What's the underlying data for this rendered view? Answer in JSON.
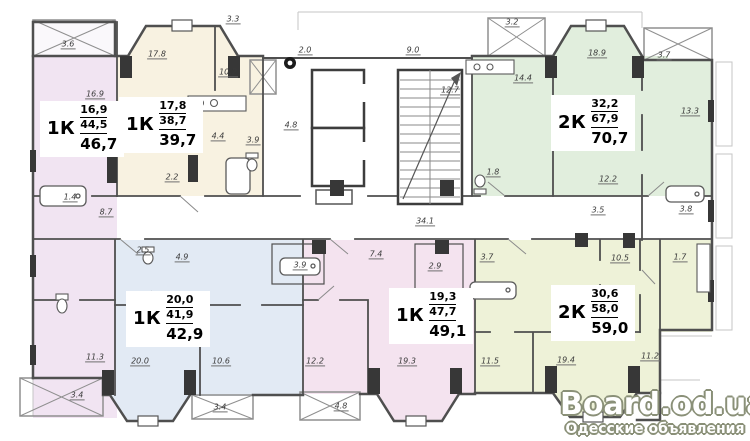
{
  "watermark": {
    "title": "Board.od.ua",
    "subtitle": "Одесские объявления"
  },
  "apartments": [
    {
      "id": "1",
      "type": "1К",
      "area_living": "16,9",
      "area_net": "44,5",
      "area_total": "46,7",
      "color": "#f1e4f2",
      "box": {
        "x": 40,
        "y": 101
      }
    },
    {
      "id": "2",
      "type": "1К",
      "area_living": "17,8",
      "area_net": "38,7",
      "area_total": "39,7",
      "color": "#f8f2e1",
      "box": {
        "x": 119,
        "y": 97
      }
    },
    {
      "id": "3",
      "type": "2К",
      "area_living": "32,2",
      "area_net": "67,9",
      "area_total": "70,7",
      "color": "#e1eedd",
      "box": {
        "x": 551,
        "y": 95
      }
    },
    {
      "id": "4",
      "type": "1К",
      "area_living": "20,0",
      "area_net": "41,9",
      "area_total": "42,9",
      "color": "#e2eaf4",
      "box": {
        "x": 126,
        "y": 291
      }
    },
    {
      "id": "5",
      "type": "1К",
      "area_living": "19,3",
      "area_net": "47,7",
      "area_total": "49,1",
      "color": "#f4e3ef",
      "box": {
        "x": 389,
        "y": 288
      }
    },
    {
      "id": "6",
      "type": "2К",
      "area_living": "30,6",
      "area_net": "58,0",
      "area_total": "59,0",
      "color": "#eef2d8",
      "box": {
        "x": 551,
        "y": 285
      }
    }
  ],
  "dimension_labels": [
    {
      "t": "3.6",
      "x": 68,
      "y": 45
    },
    {
      "t": "17.8",
      "x": 157,
      "y": 55
    },
    {
      "t": "3.3",
      "x": 233,
      "y": 20
    },
    {
      "t": "10.2",
      "x": 228,
      "y": 73
    },
    {
      "t": "2.0",
      "x": 305,
      "y": 51
    },
    {
      "t": "9.0",
      "x": 413,
      "y": 51
    },
    {
      "t": "12.7",
      "x": 450,
      "y": 91
    },
    {
      "t": "3.2",
      "x": 512,
      "y": 23
    },
    {
      "t": "18.9",
      "x": 597,
      "y": 54
    },
    {
      "t": "3.7",
      "x": 664,
      "y": 56
    },
    {
      "t": "14.4",
      "x": 523,
      "y": 79
    },
    {
      "t": "13.3",
      "x": 690,
      "y": 112
    },
    {
      "t": "16.9",
      "x": 95,
      "y": 95
    },
    {
      "t": "4.4",
      "x": 218,
      "y": 137
    },
    {
      "t": "4.8",
      "x": 291,
      "y": 126
    },
    {
      "t": "3.9",
      "x": 253,
      "y": 141
    },
    {
      "t": "2.2",
      "x": 172,
      "y": 178
    },
    {
      "t": "1.4",
      "x": 70,
      "y": 198
    },
    {
      "t": "8.7",
      "x": 106,
      "y": 213
    },
    {
      "t": "1.8",
      "x": 493,
      "y": 173
    },
    {
      "t": "12.2",
      "x": 608,
      "y": 180
    },
    {
      "t": "3.5",
      "x": 598,
      "y": 211
    },
    {
      "t": "3.8",
      "x": 686,
      "y": 210
    },
    {
      "t": "34.1",
      "x": 425,
      "y": 222
    },
    {
      "t": "2.5",
      "x": 143,
      "y": 251
    },
    {
      "t": "4.9",
      "x": 182,
      "y": 258
    },
    {
      "t": "7.4",
      "x": 376,
      "y": 255
    },
    {
      "t": "3.7",
      "x": 487,
      "y": 258
    },
    {
      "t": "10.5",
      "x": 620,
      "y": 259
    },
    {
      "t": "1.7",
      "x": 680,
      "y": 258
    },
    {
      "t": "3.9",
      "x": 300,
      "y": 266
    },
    {
      "t": "2.9",
      "x": 435,
      "y": 267
    },
    {
      "t": "11.3",
      "x": 95,
      "y": 358
    },
    {
      "t": "3.4",
      "x": 77,
      "y": 396
    },
    {
      "t": "20.0",
      "x": 140,
      "y": 362
    },
    {
      "t": "10.6",
      "x": 221,
      "y": 362
    },
    {
      "t": "3.4",
      "x": 220,
      "y": 408
    },
    {
      "t": "12.2",
      "x": 315,
      "y": 362
    },
    {
      "t": "4.8",
      "x": 341,
      "y": 407
    },
    {
      "t": "19.3",
      "x": 407,
      "y": 362
    },
    {
      "t": "11.5",
      "x": 490,
      "y": 362
    },
    {
      "t": "19.4",
      "x": 566,
      "y": 361
    },
    {
      "t": "11.2",
      "x": 650,
      "y": 357
    }
  ]
}
